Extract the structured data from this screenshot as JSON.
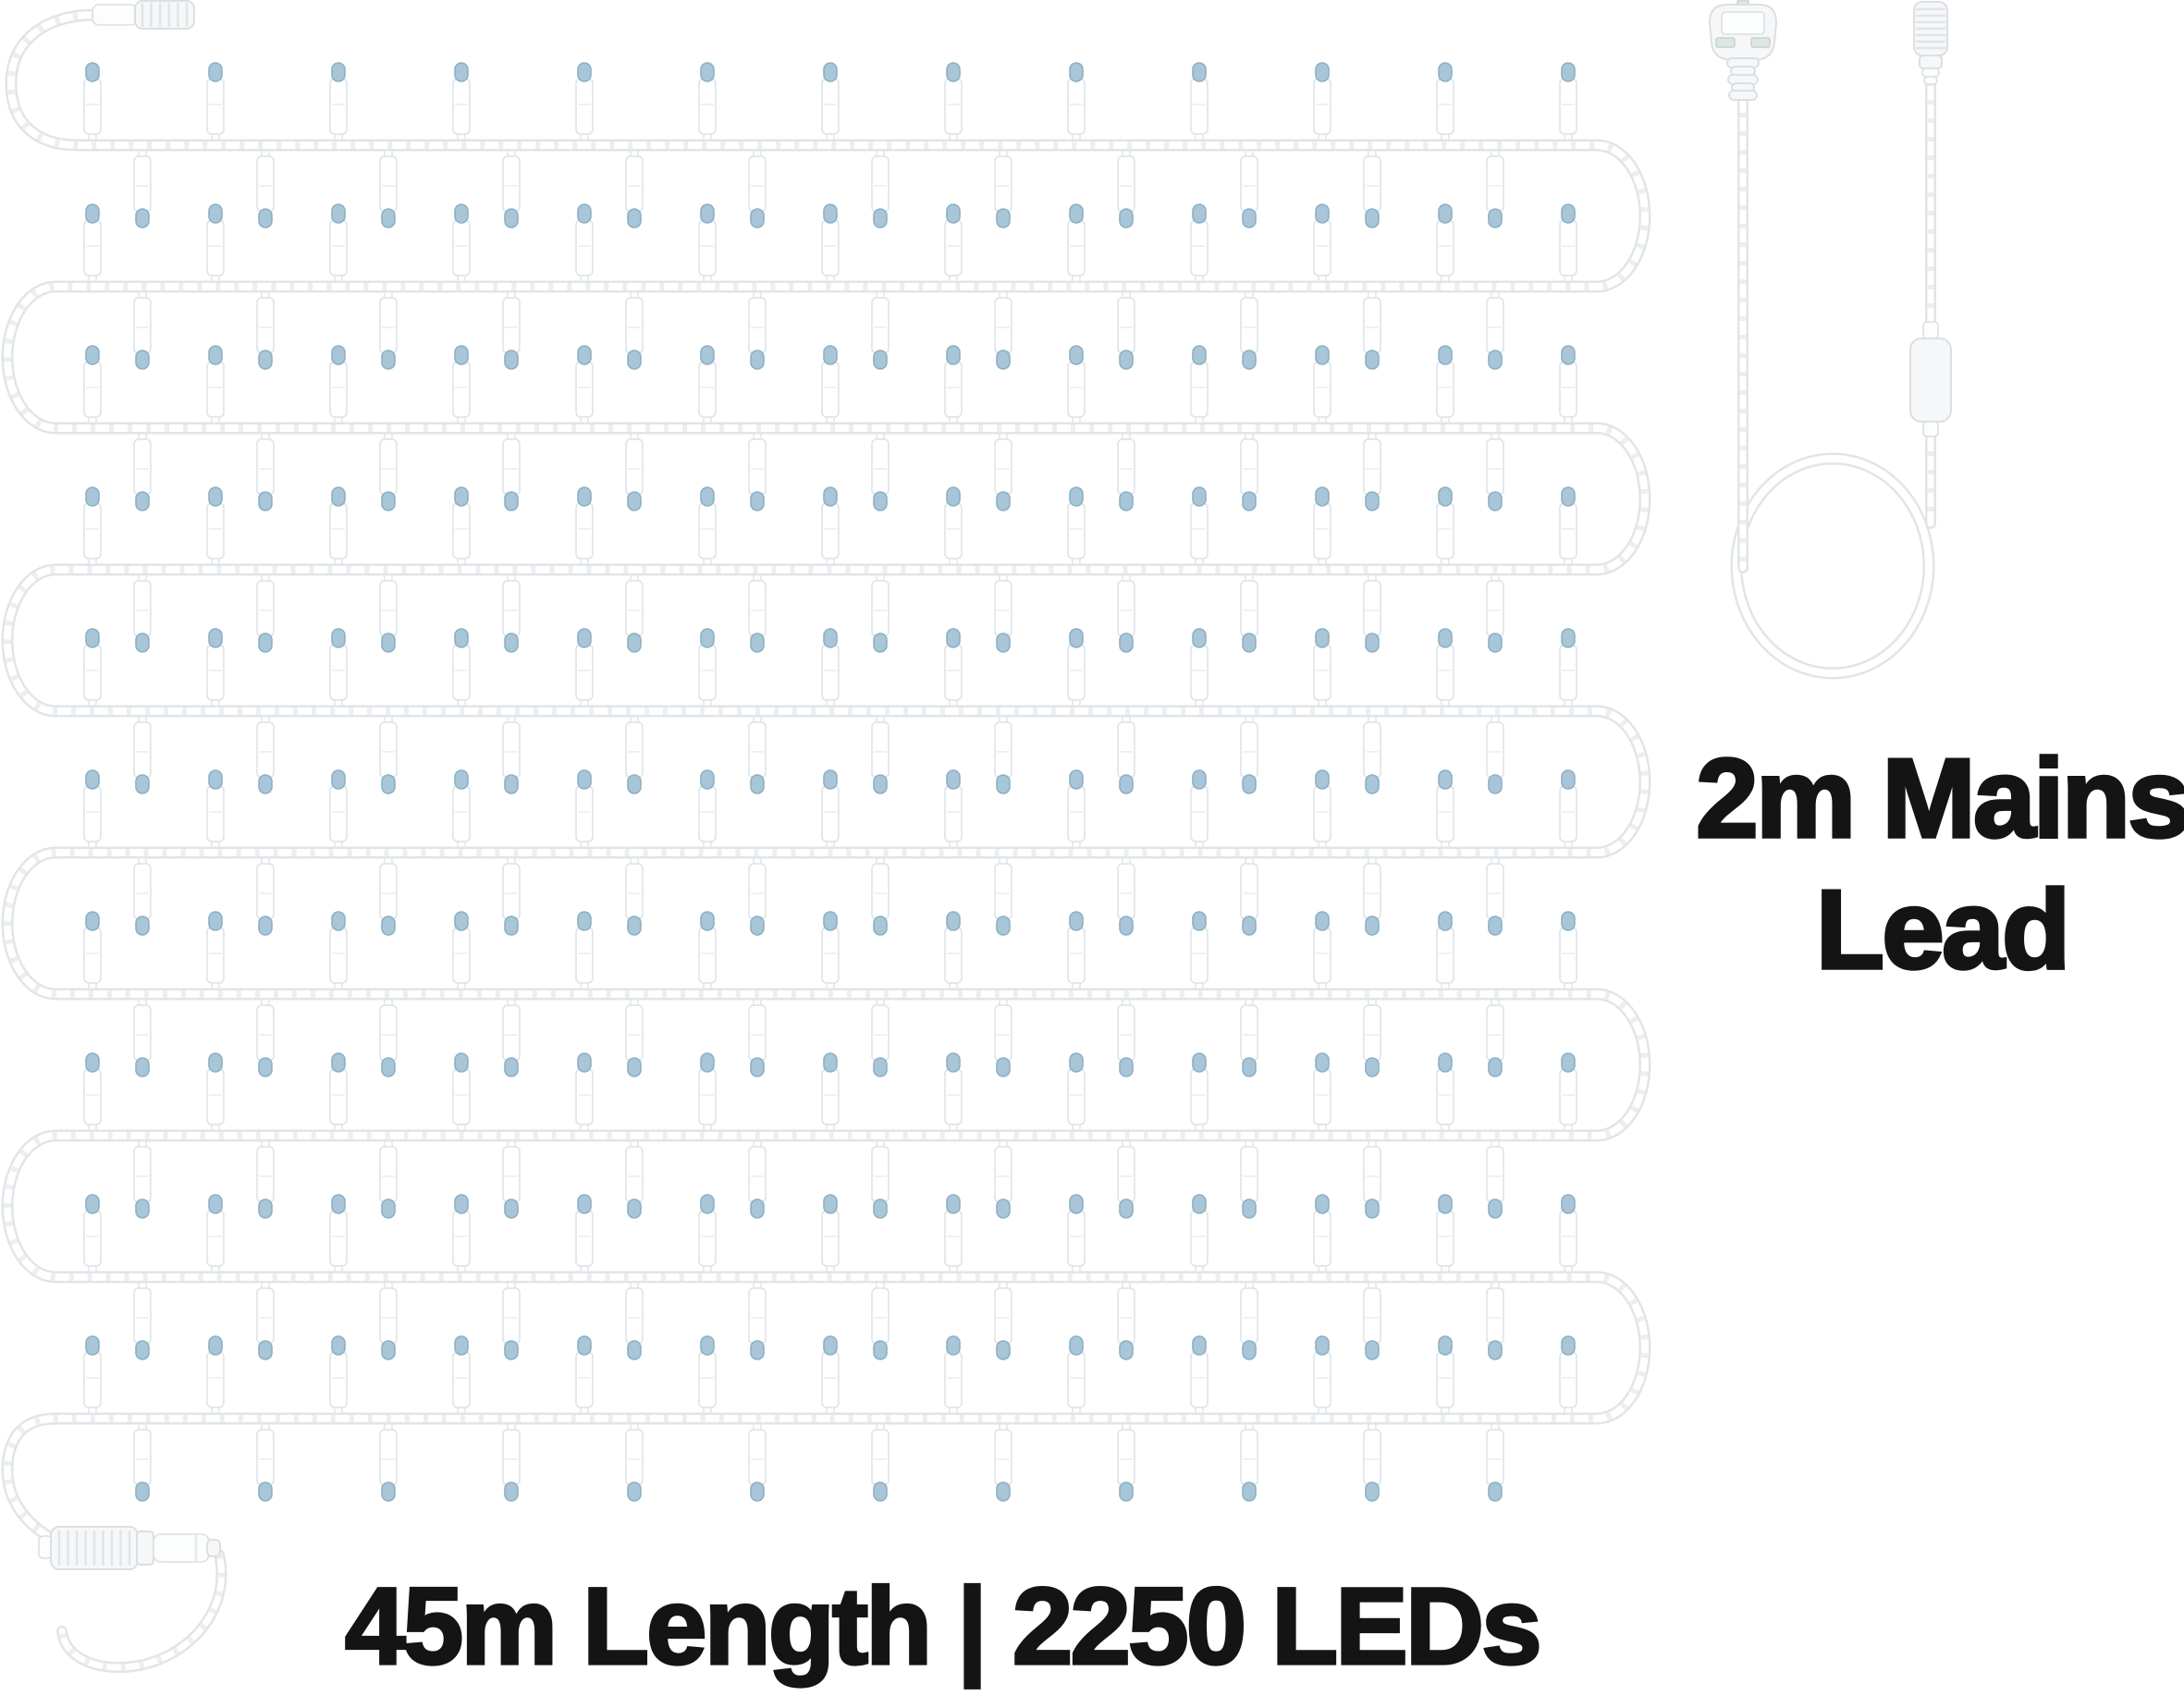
{
  "image_type": "product-illustration",
  "background": "#ffffff",
  "captions": {
    "length_leds": "45m Length | 2250 LEDs",
    "mains_lead": "2m Mains Lead",
    "mains_lead_lines": [
      "2m Mains",
      "Lead"
    ]
  },
  "specs": {
    "string_length": "45m",
    "led_count": "2250",
    "mains_lead_length": "2m"
  },
  "colors": {
    "text": "#141414",
    "cable_outline": "#e1e5e8",
    "cable_core": "#ffffff",
    "braid_hint": "#eceff1",
    "bulb_body": "#ffffff",
    "bulb_outline": "#e1e5e8",
    "bulb_tip": "#a9c6d9",
    "bulb_tip_edge": "#8db0c4",
    "hardware_fill": "#f6f7f8",
    "hardware_edge": "#dcdfe2",
    "plug_pin": "#dde7e1",
    "plug_pin_edge": "#c6d3cb"
  },
  "figures": {
    "string_lights": {
      "name": "string-lights-figure",
      "rows": 10,
      "parts": [
        "start-connector",
        "twisted-cable-serpentine",
        "led-bulbs",
        "end-connector-pair",
        "end-cable-tail"
      ]
    },
    "mains_lead": {
      "name": "mains-lead-figure",
      "parts": [
        "uk-plug",
        "strain-relief",
        "mains-cable",
        "cable-loop",
        "screw-connector",
        "inline-connector-box"
      ]
    }
  }
}
